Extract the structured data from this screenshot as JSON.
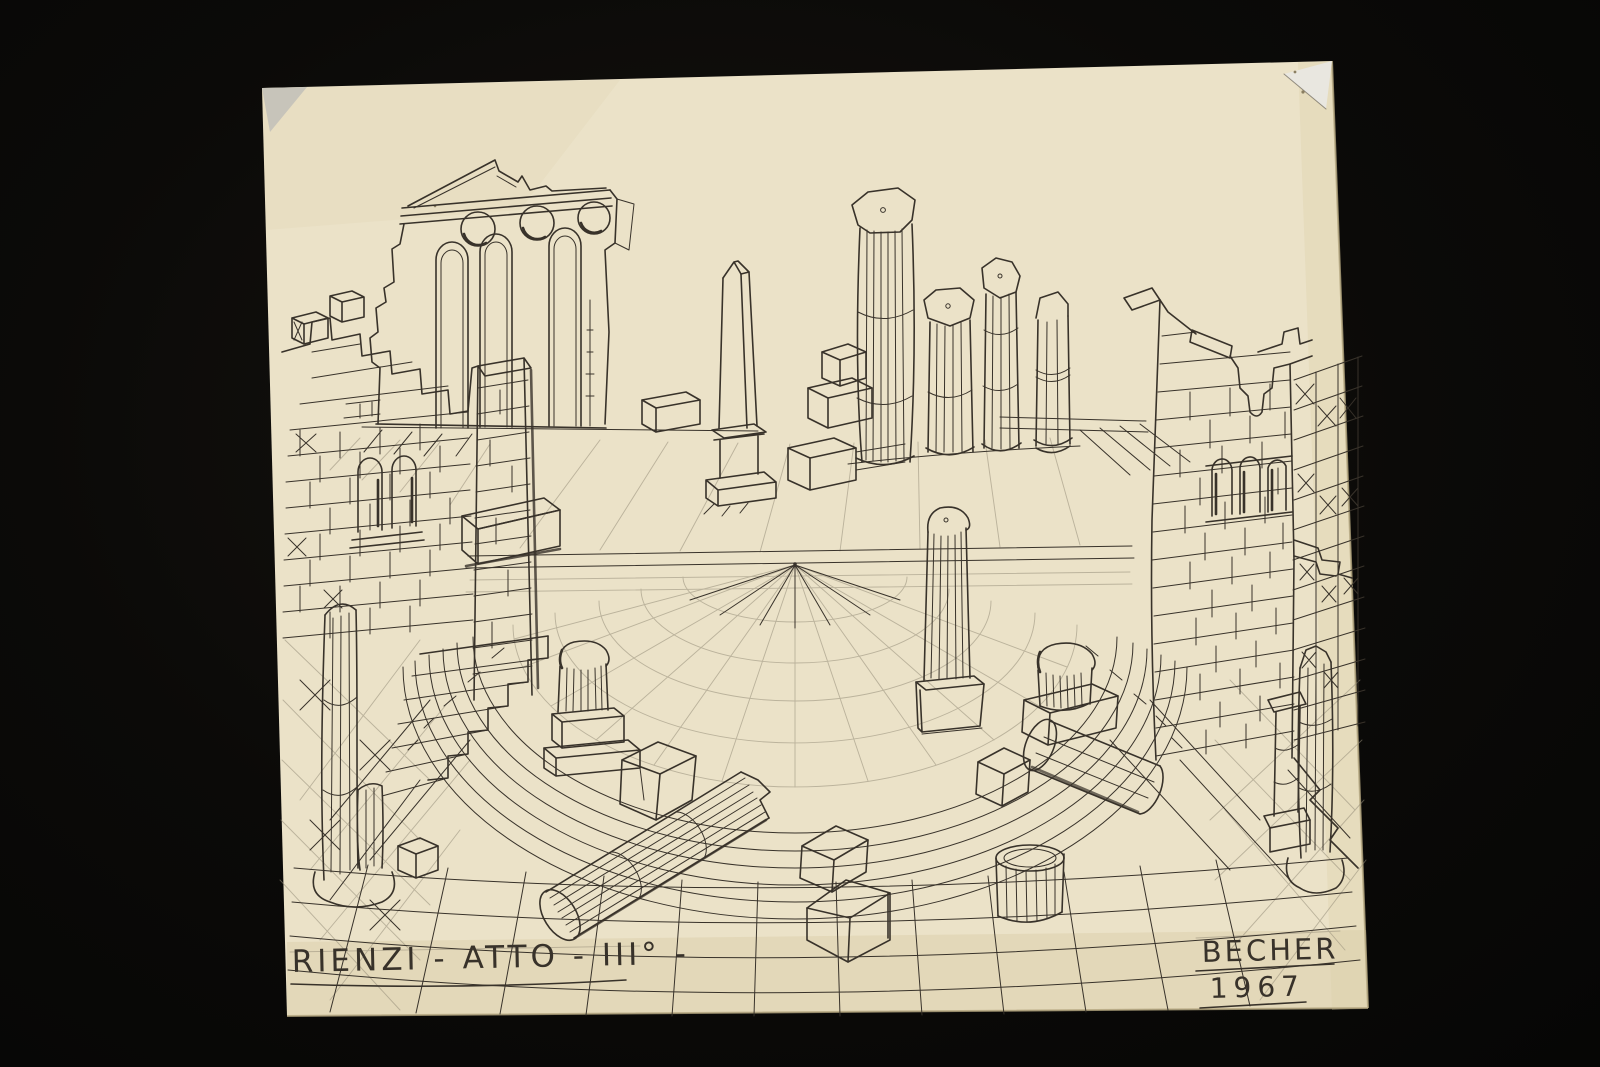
{
  "artwork": {
    "inscriptions": {
      "title": "RIENZI - ATTO - III° -",
      "signature": "BECHER",
      "year": "1967"
    },
    "colors": {
      "backdrop": "#0b0a08",
      "paper": "#ebe2c8",
      "paper-shade": "#d9cca6",
      "ink": "#38322a",
      "pencil": "#958d79",
      "tear-light": "#e9e7e0",
      "tear-gray": "#c7c4ba",
      "edge": "#b4a67f"
    }
  }
}
